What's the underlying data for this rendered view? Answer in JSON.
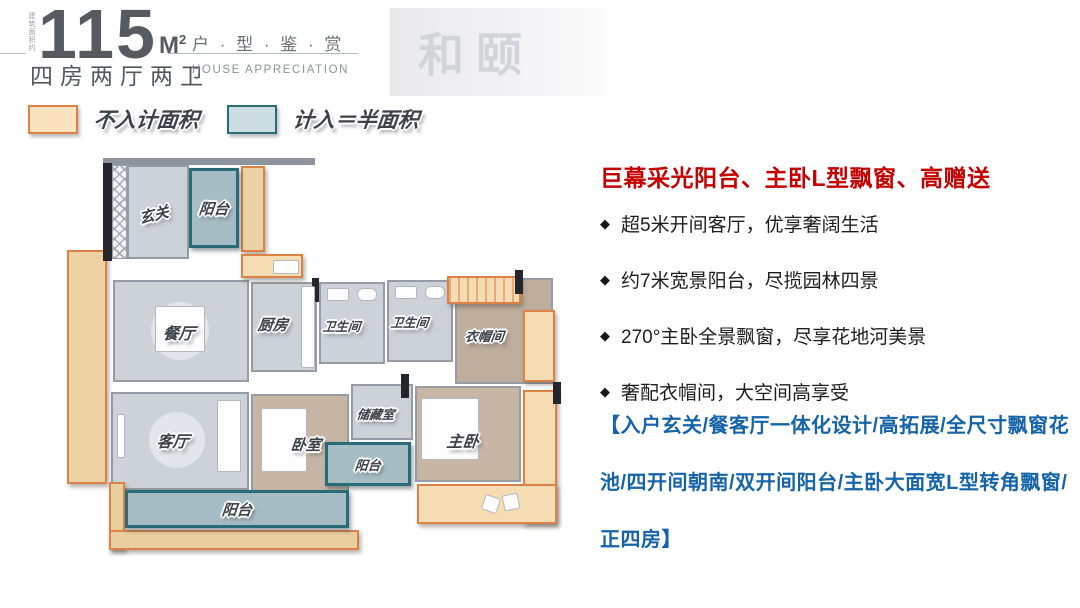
{
  "header": {
    "area_label_vertical": "建筑面积约",
    "area_number": "115",
    "area_unit_letter": "M",
    "area_unit_sup": "2",
    "apartment_type": "四房两厅两卫",
    "series_title": "户 · 型 · 鉴 · 赏",
    "series_subtitle": "HOUSE APPRECIATION",
    "watermark": "和颐"
  },
  "legend": {
    "not_counted_label": "不入计面积",
    "half_counted_label": "计入＝半面积"
  },
  "floorplan": {
    "rooms": {
      "entry": "玄关",
      "balcony_top": "阳台",
      "dining": "餐厅",
      "kitchen": "厨房",
      "bath1": "卫生间",
      "bath2": "卫生间",
      "cloakroom": "衣帽间",
      "living": "客厅",
      "bedroom": "卧室",
      "storage": "储藏室",
      "master": "主卧",
      "balcony_small": "阳台",
      "balcony_bottom": "阳台"
    }
  },
  "highlights": {
    "title": "巨幕采光阳台、主卧L型飘窗、高赠送",
    "bullet_marker": "◆",
    "bullets": [
      "超5米开间客厅，优享奢阔生活",
      "约7米宽景阳台，尽揽园林四景",
      "270°主卧全景飘窗，尽享花地河美景",
      "奢配衣帽间，大空间高享受"
    ],
    "summary": "【入户玄关/餐客厅一体化设计/高拓展/全尺寸飘窗花池/四开间朝南/双开间阳台/主卧大面宽L型转角飘窗/正四房】"
  },
  "colors": {
    "not_counted_fill": "#f6dcb2",
    "not_counted_border": "#dd8246",
    "half_counted_fill": "#a7bdc5",
    "half_counted_border": "#2a6b78",
    "highlight_red": "#c40000",
    "summary_blue": "#1563a8"
  }
}
